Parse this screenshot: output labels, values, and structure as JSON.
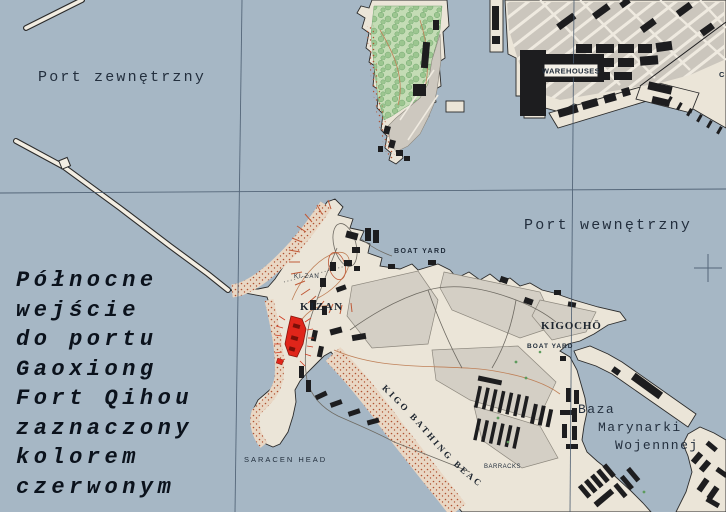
{
  "map": {
    "type": "harbor-port-map",
    "water_labels": {
      "outer_port": "Port zewnętrzny",
      "inner_port": "Port wewnętrzny"
    },
    "annotation": {
      "lines": [
        "Północne",
        "wejście",
        "do portu",
        "Gaoxiong",
        "Fort Qihou",
        "zaznaczony",
        "kolorem",
        "czerwonym"
      ]
    },
    "place_labels": {
      "warehouses": "WAREHOUSES",
      "boat_yard_north": "BOAT YARD",
      "boat_yard_kigocho": "BOAT YARD",
      "kizan_small": "KI-ZAN",
      "kizan": "KIZAN",
      "kigocho": "KIGOCHŌ",
      "kigo_bathing_beach": "KIGO BATHING BEACH",
      "barracks": "BARRACKS",
      "saracen_head": "SARACEN HEAD",
      "naval_base": [
        "Baza",
        "Marynarki",
        "Wojennnej"
      ],
      "edge_partial": "C"
    },
    "colors": {
      "water": "#a6b7c5",
      "land": "#ebe5d8",
      "urban_block": "#cdc8bf",
      "park_green": "#c4dcb5",
      "beach_stipple": "#b05232",
      "building_black": "#1d1d1f",
      "fort_red": "#e0251a",
      "grid_line": "#46586c",
      "label_ink": "#232f3e"
    }
  }
}
